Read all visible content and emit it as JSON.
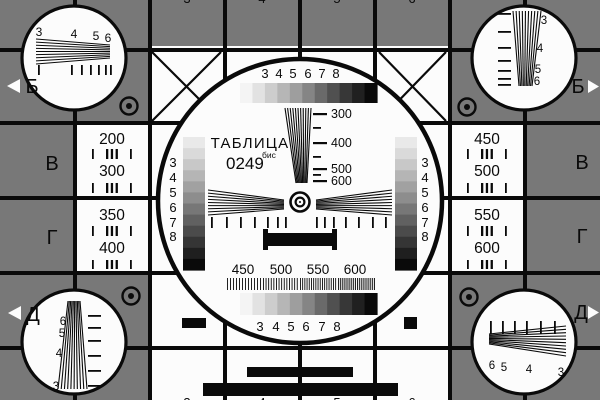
{
  "card": {
    "title": "ТАБЛИЦА",
    "code": "0249",
    "code_suffix": "бис",
    "colors": {
      "bg": "#787878",
      "white": "#fcfcfc",
      "ink": "#0a0a0a"
    },
    "row_labels_left": [
      "Б",
      "В",
      "Г",
      "Д"
    ],
    "row_labels_right": [
      "Б",
      "В",
      "Г",
      "Д"
    ],
    "top_cut_digits": [
      "3",
      "4",
      "5",
      "6"
    ],
    "bottom_cut_digits": [
      "3",
      "4",
      "5",
      "6"
    ],
    "step_labels": [
      "3",
      "4",
      "5",
      "6",
      "7",
      "8"
    ],
    "center_wedge_labels": [
      "300",
      "400",
      "500",
      "600"
    ],
    "bottom_band_labels": [
      "450",
      "500",
      "550",
      "600"
    ],
    "freq_cells": {
      "left_top": [
        "200",
        "300"
      ],
      "left_bottom": [
        "350",
        "400"
      ],
      "right_top": [
        "450",
        "500"
      ],
      "right_bottom": [
        "550",
        "600"
      ]
    },
    "corner_labels": {
      "top_left": [
        "3",
        "4",
        "5",
        "6"
      ],
      "top_right": [
        "3",
        "4",
        "5",
        "6"
      ],
      "bottom_left": [
        "6",
        "5",
        "4",
        "3"
      ],
      "bottom_right": [
        "6",
        "5",
        "4",
        "3"
      ]
    },
    "grayscale_h": [
      "#f4f4f4",
      "#e2e2e2",
      "#cdcdcd",
      "#b6b6b6",
      "#9e9e9e",
      "#858585",
      "#6a6a6a",
      "#505050",
      "#373737",
      "#202020",
      "#0a0a0a"
    ],
    "grayscale_v": [
      "#e9e9e9",
      "#dadada",
      "#c8c8c8",
      "#b5b5b5",
      "#a1a1a1",
      "#8d8d8d",
      "#777777",
      "#616161",
      "#4b4b4b",
      "#353535",
      "#1f1f1f",
      "#0a0a0a"
    ]
  }
}
